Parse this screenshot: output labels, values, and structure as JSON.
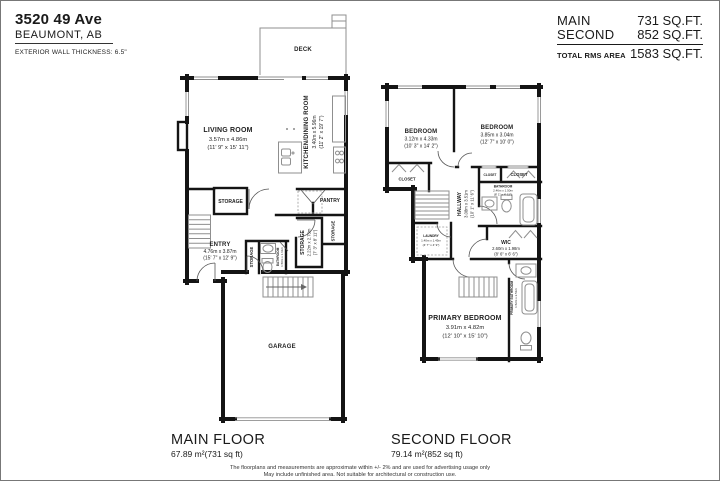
{
  "header": {
    "address_line1": "3520 49 Ave",
    "address_line2": "BEAUMONT, AB",
    "wall_note": "EXTERIOR WALL THICKNESS: 6.5\"",
    "areas": [
      {
        "label": "MAIN",
        "value": "731 SQ.FT."
      },
      {
        "label": "SECOND",
        "value": "852 SQ.FT."
      },
      {
        "label": "TOTAL RMS AREA",
        "value": "1583 SQ.FT."
      }
    ]
  },
  "main_floor": {
    "title": "MAIN FLOOR",
    "area": "67.89 m²(731 sq ft)",
    "rooms": {
      "deck": {
        "name": "DECK"
      },
      "living": {
        "name": "LIVING ROOM",
        "m": "3.57m x 4.86m",
        "ft": "(11' 9\" x 15' 11\")"
      },
      "kitchen": {
        "name": "KITCHEN/DINING ROOM",
        "m": "3.40m x 5.96m",
        "ft": "(11' 2\" x 19' 7\")"
      },
      "storage_top": {
        "name": "STORAGE"
      },
      "pantry": {
        "name": "PANTRY"
      },
      "entry": {
        "name": "ENTRY",
        "m": "4.76m x 3.87m",
        "ft": "(15' 7\" x 12' 9\")"
      },
      "storage_closet": {
        "name": "STORAGE"
      },
      "bathroom": {
        "name": "BATHROOM",
        "m": "1.50m x 1.61m",
        "ft": "(4' 11\" x 5' 3\")"
      },
      "storage_mid": {
        "name": "STORAGE",
        "m": "2.22m x 2.73m",
        "ft": "(7' 3\" x 8' 11\")"
      },
      "storage_right": {
        "name": "STORAGE"
      },
      "garage": {
        "name": "GARAGE"
      }
    }
  },
  "second_floor": {
    "title": "SECOND FLOOR",
    "area": "79.14 m²(852 sq ft)",
    "rooms": {
      "bedroom_left": {
        "name": "BEDROOM",
        "m": "3.12m x 4.33m",
        "ft": "(10' 3\" x 14' 2\")"
      },
      "bedroom_right": {
        "name": "BEDROOM",
        "m": "3.85m x 3.04m",
        "ft": "(12' 7\" x 10' 0\")"
      },
      "closet_left": {
        "name": "CLOSET"
      },
      "closet_mid": {
        "name": "CLOSET"
      },
      "closet_right": {
        "name": "CLOSET"
      },
      "bathroom": {
        "name": "BATHROOM",
        "m": "2.46m x 1.50m",
        "ft": "(8' 1\" x 4' 11\")"
      },
      "hallway": {
        "name": "HALLWAY",
        "m": "3.08m x 3.51m",
        "ft": "(10' 1\" x 11' 6\")"
      },
      "laundry": {
        "name": "LAUNDRY",
        "m": "1.40m x 1.45m",
        "ft": "(4' 7\" x 4' 9\")"
      },
      "wic": {
        "name": "WIC",
        "m": "2.60m x 1.98m",
        "ft": "(8' 6\" x 6' 6\")"
      },
      "primary_bedroom": {
        "name": "PRIMARY BEDROOM",
        "m": "3.91m x 4.82m",
        "ft": "(12' 10\" x 15' 10\")"
      },
      "primary_bathroom": {
        "name": "PRIMARY BATHROOM",
        "m": "1.52m x 2.51m",
        "ft": "(5' 0\" x 8' 3\")"
      }
    }
  },
  "footer": {
    "disclaimer1": "The floorplans and measurements are approximate within +/- 2% and are used for advertising usage only",
    "disclaimer2": "May include unfinished area. Not suitable for architectural or construction use."
  },
  "colors": {
    "wall": "#141414",
    "fixture": "#8f8f8f",
    "text": "#1f1f1f"
  }
}
